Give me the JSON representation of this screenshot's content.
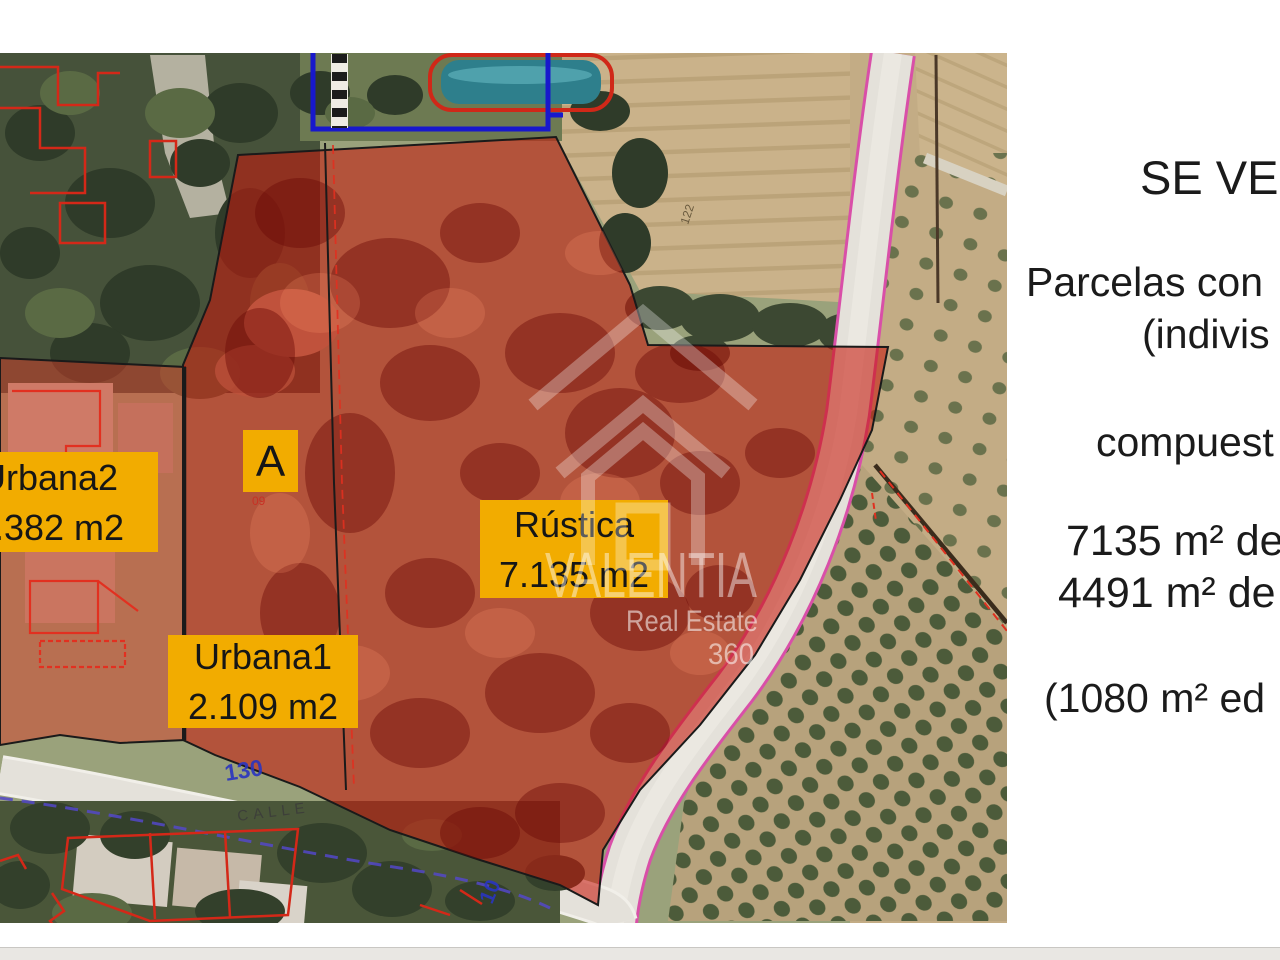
{
  "listing": {
    "title": "SE VEN",
    "line1": "Parcelas con",
    "line2": "(indivis",
    "line3": "compuest",
    "area1": "7135 m² de",
    "area2": "4491 m² de",
    "area3": "(1080 m² ed"
  },
  "map": {
    "parcel_labels": {
      "urbana2_name": "Urbana2",
      "urbana2_area": "2.382 m2",
      "urbana1_name": "Urbana1",
      "urbana1_area": "2.109 m2",
      "rustica_name": "Rústica",
      "rustica_area": "7.135 m2",
      "zone_a": "A",
      "zone_a_code": "09"
    },
    "street_labels": {
      "house_number": "130",
      "street_name": "CALLE",
      "road_number": "10",
      "plot_number": "122"
    },
    "colors": {
      "parcel_overlay_red": "#c41c10",
      "label_yellow": "#f2ac00",
      "cadastral_blue": "#1818cc",
      "cadastral_red": "#d42818",
      "road_edge_pink": "#d94fa8",
      "street_text_blue": "#2a35c0"
    }
  },
  "watermark": {
    "brand": "VALENTIA",
    "tagline": "Real Estate",
    "suffix": "360"
  }
}
